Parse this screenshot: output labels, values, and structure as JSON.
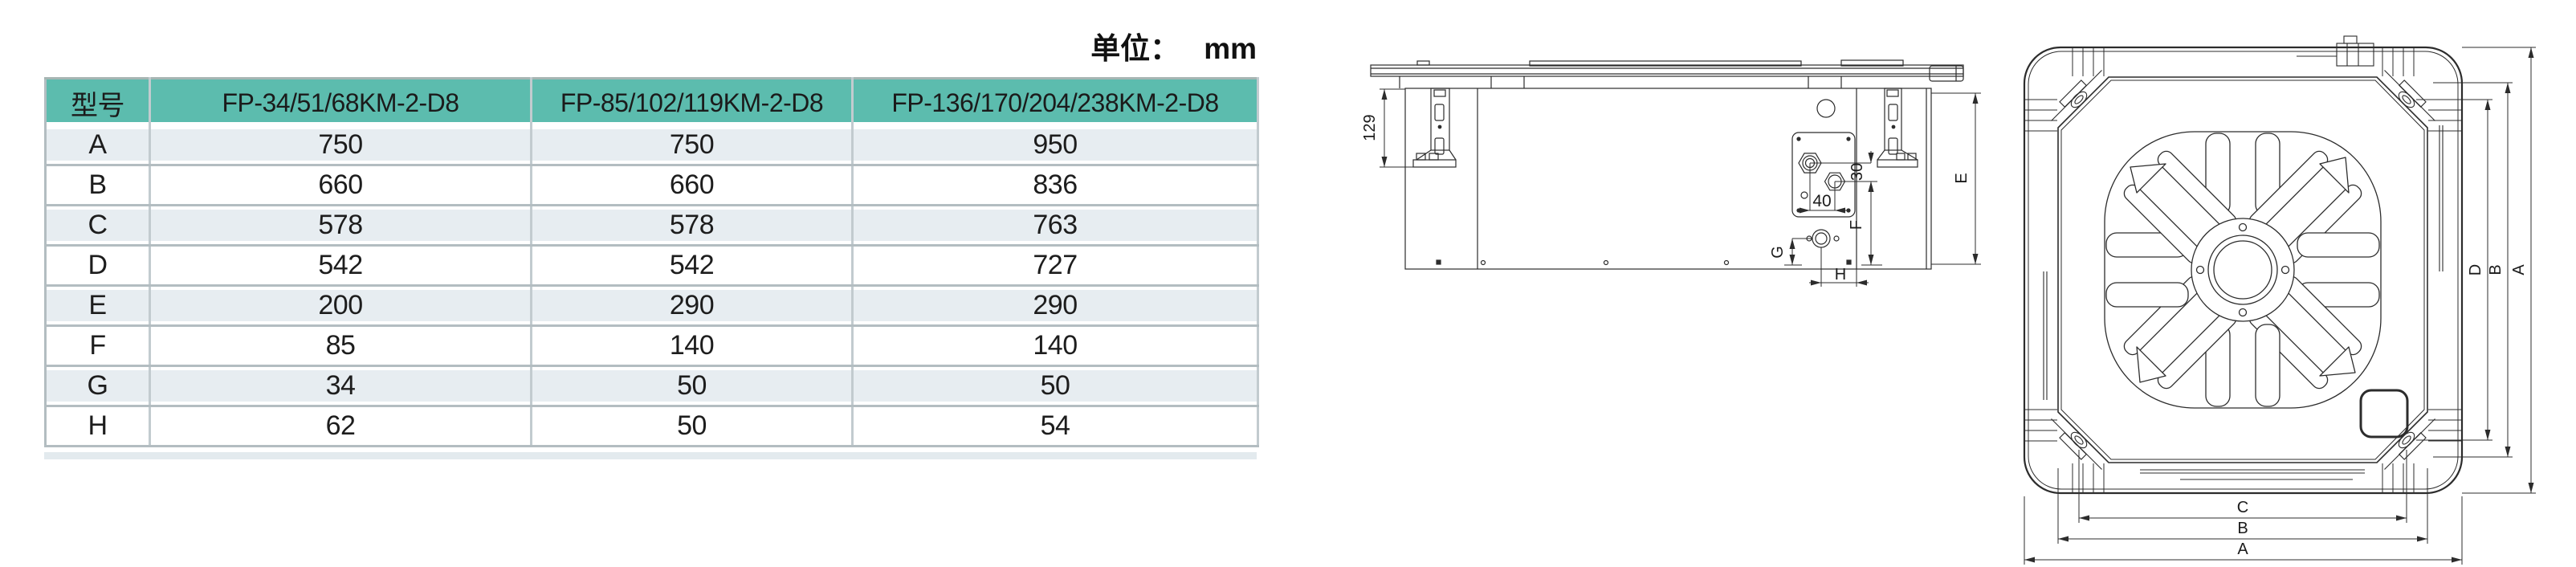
{
  "unit": {
    "prefix": "单位：",
    "value": "mm"
  },
  "table": {
    "columns": [
      "型号",
      "FP-34/51/68KM-2-D8",
      "FP-85/102/119KM-2-D8",
      "FP-136/170/204/238KM-2-D8"
    ],
    "rows": [
      {
        "param": "A",
        "values": [
          "750",
          "750",
          "950"
        ]
      },
      {
        "param": "B",
        "values": [
          "660",
          "660",
          "836"
        ]
      },
      {
        "param": "C",
        "values": [
          "578",
          "578",
          "763"
        ]
      },
      {
        "param": "D",
        "values": [
          "542",
          "542",
          "727"
        ]
      },
      {
        "param": "E",
        "values": [
          "200",
          "290",
          "290"
        ]
      },
      {
        "param": "F",
        "values": [
          "85",
          "140",
          "140"
        ]
      },
      {
        "param": "G",
        "values": [
          "34",
          "50",
          "50"
        ]
      },
      {
        "param": "H",
        "values": [
          "62",
          "50",
          "54"
        ]
      }
    ]
  },
  "drawings": {
    "side_view": {
      "hanger_height": "129",
      "pipe_spacing_h": "40",
      "pipe_spacing_v": "30",
      "f": "F",
      "g": "G",
      "h": "H",
      "e": "E"
    },
    "bottom_view": {
      "right": [
        "D",
        "B",
        "A"
      ],
      "bottom": [
        "C",
        "B",
        "A"
      ]
    }
  },
  "colors": {
    "header_bg": "#5cbcae",
    "row_alt_bg": "#e7edf1",
    "grid_line": "#c2cbcf",
    "row_line": "#b3bdc1",
    "text": "#1d1d1d"
  }
}
